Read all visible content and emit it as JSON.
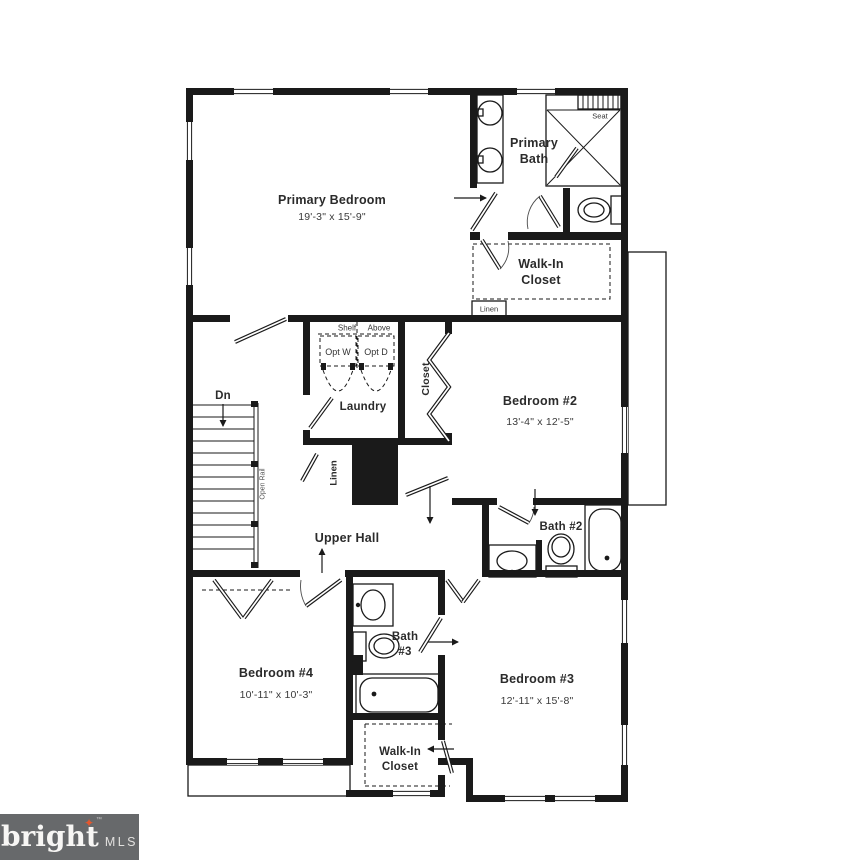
{
  "meta": {
    "type": "residential floor plan",
    "floor": "upper level"
  },
  "colors": {
    "wall": "#1a1a1a",
    "text": "#2b2b2b",
    "logo_bg": "#67696B",
    "logo_star": "#E4572E"
  },
  "rooms": {
    "primary_bedroom": {
      "name": "Primary Bedroom",
      "dims": "19'-3\" x 15'-9\""
    },
    "primary_bath": {
      "name": "Primary Bath"
    },
    "walk_in_closet_upper": {
      "name": "Walk-In Closet"
    },
    "bedroom_2": {
      "name": "Bedroom #2",
      "dims": "13'-4\" x 12'-5\""
    },
    "laundry": {
      "name": "Laundry"
    },
    "upper_hall": {
      "name": "Upper Hall"
    },
    "bath_2": {
      "name": "Bath #2"
    },
    "bedroom_4": {
      "name": "Bedroom #4",
      "dims": "10'-11\" x 10'-3\""
    },
    "bath_3": {
      "name": "Bath #3"
    },
    "bedroom_3": {
      "name": "Bedroom #3",
      "dims": "12'-11\" x 15'-8\""
    },
    "walk_in_closet_lower": {
      "name": "Walk-In Closet"
    }
  },
  "annotations": {
    "seat": "Seat",
    "linen_upper": "Linen",
    "linen_hall": "Linen",
    "shelf": "Shelf",
    "above": "Above",
    "opt_w": "Opt W",
    "opt_d": "Opt D",
    "closet": "Closet",
    "dn": "Dn",
    "open_rail": "Open Rail"
  },
  "logo": {
    "brand": "bright",
    "tm": "™",
    "suffix": "MLS"
  }
}
